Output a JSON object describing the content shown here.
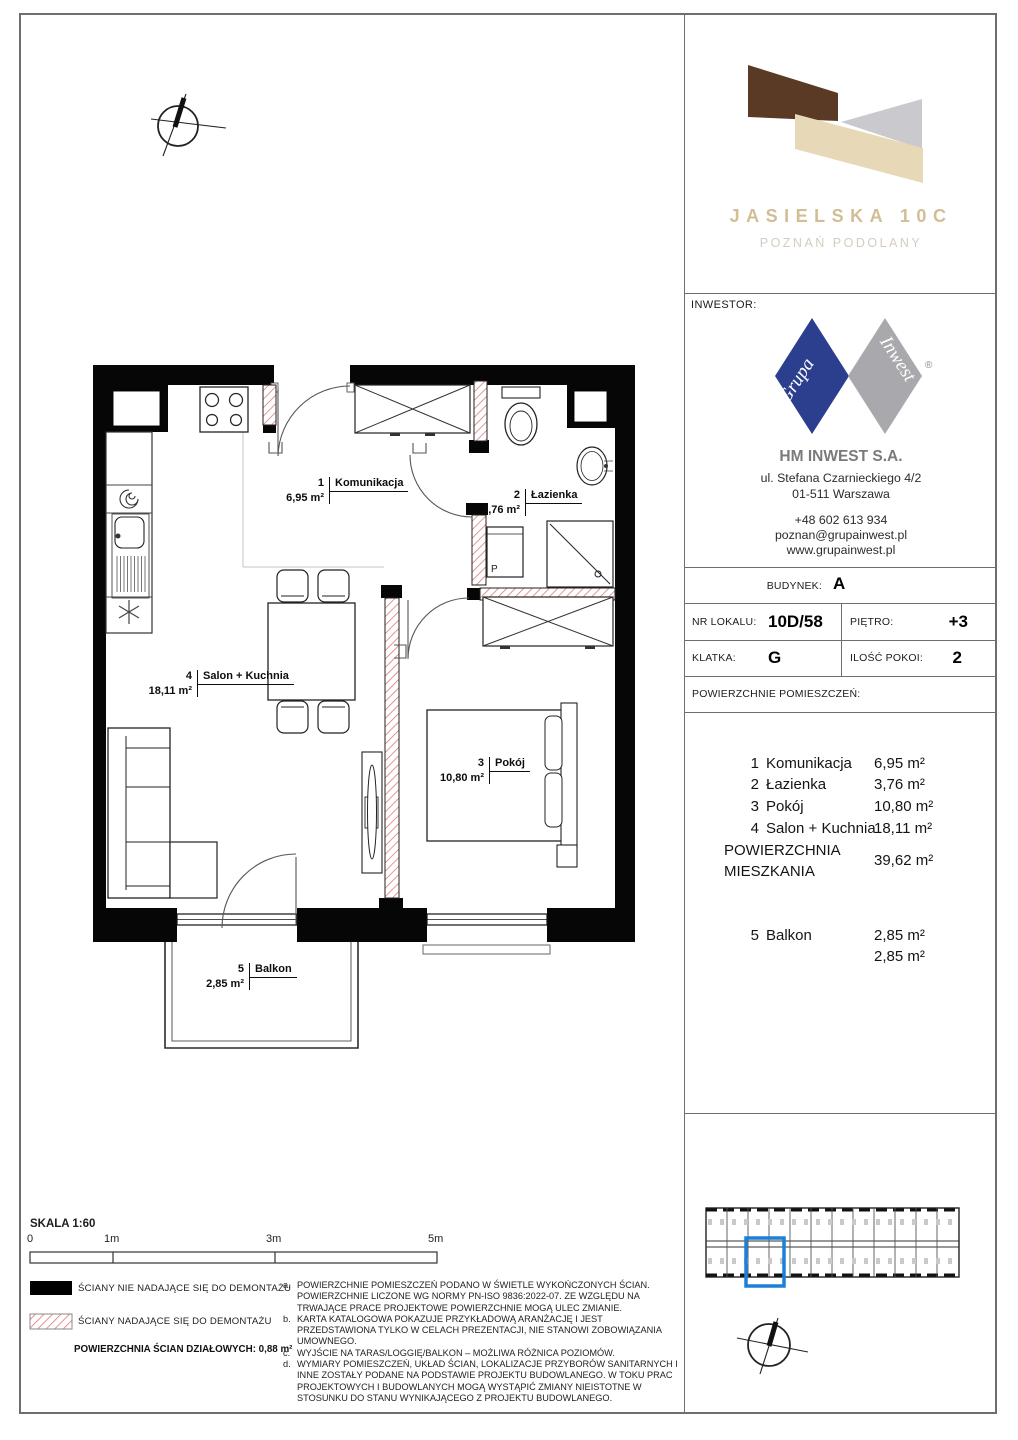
{
  "brand": {
    "title": "JASIELSKA 10C",
    "subtitle": "POZNAŃ PODOLANY"
  },
  "investor": {
    "label": "INWESTOR:",
    "logo_left": "Grupa",
    "logo_right": "Inwest",
    "registered": "®",
    "company": "HM INWEST S.A.",
    "address1": "ul. Stefana Czarnieckiego 4/2",
    "address2": "01-511 Warszawa",
    "phone": "+48 602 613 934",
    "email": "poznan@grupainwest.pl",
    "website": "www.grupainwest.pl"
  },
  "details": {
    "budynek_label": "BUDYNEK:",
    "budynek": "A",
    "nr_lokalu_label": "NR LOKALU:",
    "nr_lokalu": "10D/58",
    "pietro_label": "PIĘTRO:",
    "pietro": "+3",
    "klatka_label": "KLATKA:",
    "klatka": "G",
    "ilosc_pokoi_label": "ILOŚĆ POKOI:",
    "ilosc_pokoi": "2",
    "areas_header": "POWIERZCHNIE POMIESZCZEŃ:"
  },
  "areas": {
    "rooms": [
      {
        "no": "1",
        "name": "Komunikacja",
        "value": "6,95 m²"
      },
      {
        "no": "2",
        "name": "Łazienka",
        "value": "3,76 m²"
      },
      {
        "no": "3",
        "name": "Pokój",
        "value": "10,80 m²"
      },
      {
        "no": "4",
        "name": "Salon + Kuchnia",
        "value": "18,11 m²"
      }
    ],
    "total_label1": "POWIERZCHNIA",
    "total_label2": "MIESZKANIA",
    "total_value": "39,62 m²",
    "balcony": {
      "no": "5",
      "name": "Balkon",
      "value": "2,85 m²"
    },
    "balcony_total": "2,85 m²"
  },
  "plan": {
    "labels": [
      {
        "no": "1",
        "name": "Komunikacja",
        "area": "6,95 m²"
      },
      {
        "no": "2",
        "name": "Łazienka",
        "area": "3,76 m²"
      },
      {
        "no": "3",
        "name": "Pokój",
        "area": "10,80 m²"
      },
      {
        "no": "4",
        "name": "Salon + Kuchnia",
        "area": "18,11 m²"
      },
      {
        "no": "5",
        "name": "Balkon",
        "area": "2,85 m²"
      }
    ],
    "washer_letter": "P"
  },
  "scale": {
    "label": "SKALA 1:60",
    "ticks": [
      "0",
      "1m",
      "3m",
      "5m"
    ]
  },
  "legend": {
    "solid": "ŚCIANY NIE NADAJĄCE SIĘ DO DEMONTAŻU",
    "hatched": "ŚCIANY NADAJĄCE SIĘ DO DEMONTAŻU",
    "partition": "POWIERZCHNIA ŚCIAN DZIAŁOWYCH: 0,88 m²"
  },
  "notes": [
    {
      "letter": "a.",
      "text": "POWIERZCHNIE POMIESZCZEŃ PODANO W ŚWIETLE WYKOŃCZONYCH ŚCIAN. POWIERZCHNIE LICZONE WG NORMY PN-ISO 9836:2022-07. ZE WZGLĘDU NA TRWAJĄCE PRACE PROJEKTOWE POWIERZCHNIE MOGĄ ULEC ZMIANIE."
    },
    {
      "letter": "b.",
      "text": "KARTA KATALOGOWA POKAZUJE PRZYKŁADOWĄ ARANŻACJĘ I JEST PRZEDSTAWIONA TYLKO W CELACH PREZENTACJI, NIE STANOWI ZOBOWIĄZANIA UMOWNEGO."
    },
    {
      "letter": "c.",
      "text": "WYJŚCIE NA TARAS/LOGGIĘ/BALKON – MOŻLIWA RÓŻNICA POZIOMÓW."
    },
    {
      "letter": "d.",
      "text": "WYMIARY POMIESZCZEŃ, UKŁAD ŚCIAN, LOKALIZACJE PRZYBORÓW SANITARNYCH I INNE ZOSTAŁY PODANE NA PODSTAWIE PROJEKTU BUDOWLANEGO. W TOKU PRAC PROJEKTOWYCH I BUDOWLANYCH MOGĄ WYSTĄPIĆ ZMIANY NIEISTOTNE W STOSUNKU DO STANU WYNIKAJĄCEGO Z PROJEKTU BUDOWLANEGO."
    }
  ],
  "colors": {
    "highlight_blue": "#1d80d6",
    "hatch_red": "#dd7272",
    "logo_brown": "#5b3a25",
    "logo_beige": "#e7d8b8",
    "logo_gray": "#c9c9ce",
    "brand_text": "#d2bd97",
    "diamond_blue": "#2c3f8f",
    "diamond_gray": "#a9a9ad"
  }
}
